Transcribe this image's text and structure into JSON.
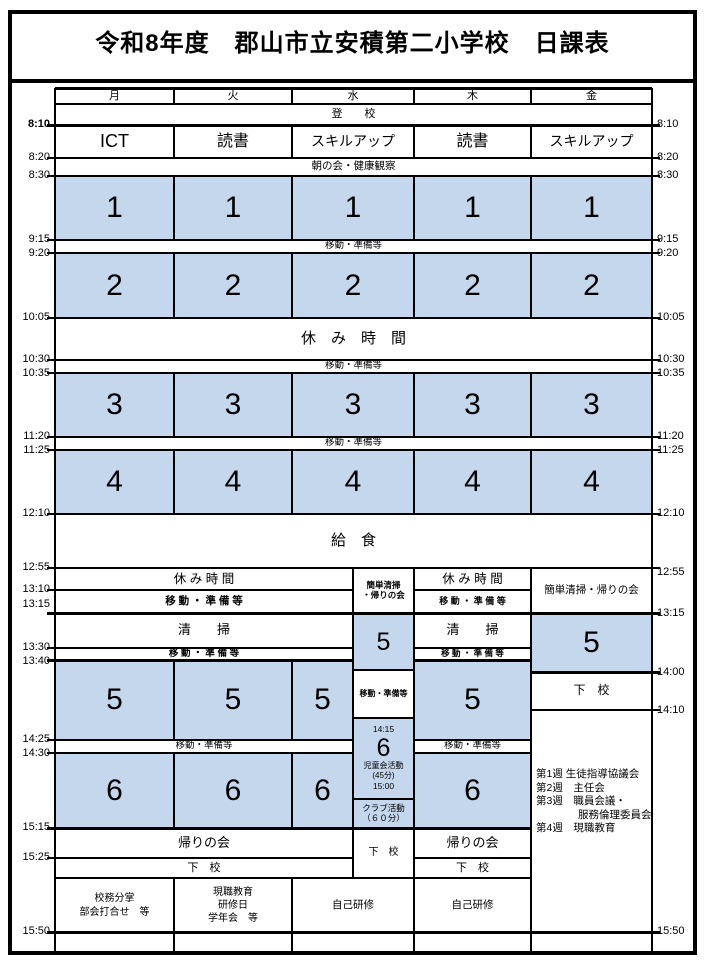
{
  "title": "令和8年度　郡山市立安積第二小学校　日課表",
  "days": [
    "月",
    "火",
    "水",
    "木",
    "金"
  ],
  "common": {
    "toko": "登　　校",
    "asa": "朝の会・健康観察",
    "ido": "移動・準備等",
    "ido_sp": "移 動 ・ 準 備 等",
    "yasumi_wide": "休　み　時　間",
    "yasumi": "休 み 時 間",
    "kyushoku": "給　食",
    "seiso": "清　　掃",
    "kaeri": "帰りの会",
    "geko": "下　校",
    "kantan": "簡単清掃・帰りの会",
    "kantan_l1": "簡単清掃",
    "kantan_l2": "・帰りの会",
    "jiko": "自己研修"
  },
  "periods": {
    "p1": "1",
    "p2": "2",
    "p3": "3",
    "p4": "4",
    "p5": "5",
    "p6": "6"
  },
  "morning": {
    "mon": "ICT",
    "tue": "読書",
    "wed": "スキルアップ",
    "thu": "読書",
    "fri": "スキルアップ"
  },
  "wed_right": {
    "t1415": "14:15",
    "jido_l1": "児童会活動",
    "jido_l2": "(45分)",
    "jido_l3": "15:00",
    "club_l1": "クラブ活動",
    "club_l2": "（６０分）"
  },
  "fri_notes": {
    "l1": "第1週 生徒指導協議会",
    "l2": "第2週　主任会",
    "l3": "第3週　職員会議・",
    "l4": "　　　　服務倫理委員会",
    "l5": "第4週　現職教育"
  },
  "after_school": {
    "mon_l1": "校務分掌",
    "mon_l2": "部会打合せ　等",
    "tue_l1": "現職教育",
    "tue_l2": "研修日",
    "tue_l3": "学年会　等"
  },
  "times_left": [
    "8:10",
    "8:20",
    "8:30",
    "9:15",
    "9:20",
    "10:05",
    "10:30",
    "10:35",
    "11:20",
    "11:25",
    "12:10",
    "12:55",
    "13:10",
    "13:15",
    "13:30",
    "13:40",
    "14:25",
    "14:30",
    "15:15",
    "15:25",
    "15:50"
  ],
  "times_right": [
    "8:10",
    "8:20",
    "8:30",
    "9:15",
    "9:20",
    "10:05",
    "10:30",
    "10:35",
    "11:20",
    "11:25",
    "12:10",
    "12:55",
    "13:15",
    "14:00",
    "14:10",
    "15:50"
  ],
  "colors": {
    "period_fill": "#c5d7ec",
    "line": "#000000"
  }
}
